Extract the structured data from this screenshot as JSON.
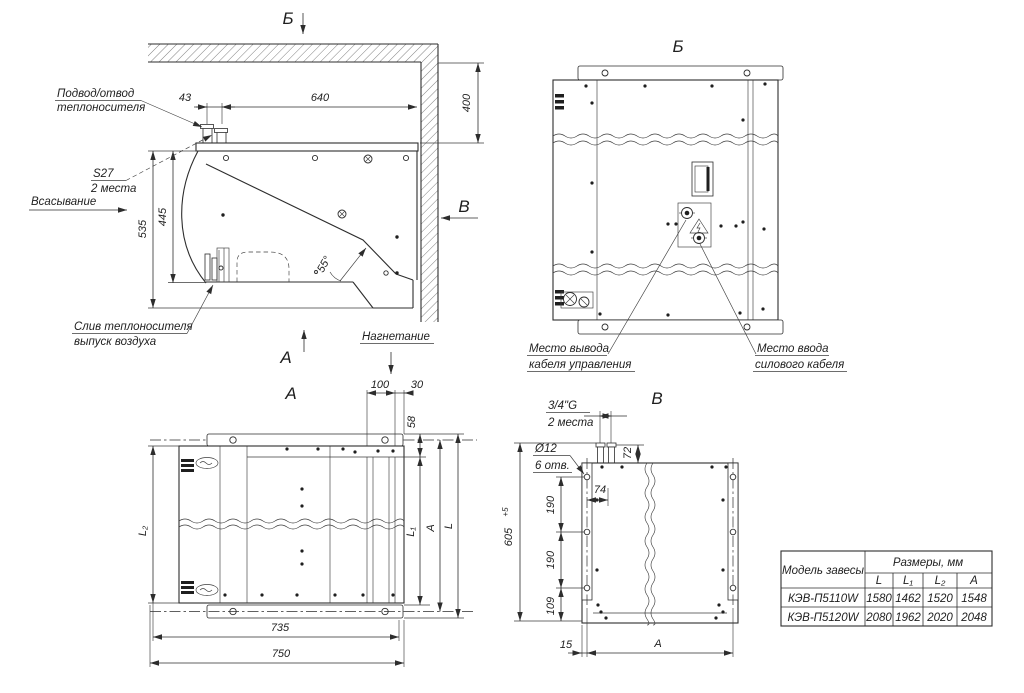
{
  "side_view": {
    "marker_b_top": "Б",
    "marker_a": "А",
    "marker_v": "В",
    "label_supply_1": "Подвод/отвод",
    "label_supply_2": "теплоносителя",
    "label_s27_1": "S27",
    "label_s27_2": "2 места",
    "label_suction": "Всасывание",
    "label_drain_1": "Слив теплоносителя",
    "label_drain_2": "выпуск воздуха",
    "label_discharge": "Нагнетание",
    "dim_43": "43",
    "dim_640": "640",
    "dim_400": "400",
    "dim_535": "535",
    "dim_445": "445",
    "dim_55": "55°"
  },
  "view_b": {
    "title": "Б",
    "label_control_1": "Место вывода",
    "label_control_2": "кабеля управления",
    "label_power_1": "Место ввода",
    "label_power_2": "силового кабеля"
  },
  "view_a": {
    "title": "А",
    "dim_100": "100",
    "dim_30": "30",
    "dim_58": "58",
    "dim_l1": "L₁",
    "dim_l2": "L₂",
    "dim_a": "А",
    "dim_l": "L",
    "dim_735": "735",
    "dim_750": "750"
  },
  "view_v": {
    "title": "В",
    "label_thread_1": "3/4\"G",
    "label_thread_2": "2 места",
    "label_holes_1": "Ø12",
    "label_holes_2": "6 отв.",
    "dim_72": "72",
    "dim_74": "74",
    "dim_190a": "190",
    "dim_190b": "190",
    "dim_109": "109",
    "dim_605": "605",
    "dim_605_tol": "+5",
    "dim_15": "15",
    "dim_a": "А"
  },
  "table": {
    "header_model": "Модель завесы",
    "header_sizes": "Размеры, мм",
    "col_l": "L",
    "col_l1": "L₁",
    "col_l2": "L₂",
    "col_a": "A",
    "rows": [
      {
        "model": "КЭВ-П5110W",
        "l": "1580",
        "l1": "1462",
        "l2": "1520",
        "a": "1548"
      },
      {
        "model": "КЭВ-П5120W",
        "l": "2080",
        "l1": "1962",
        "l2": "2020",
        "a": "2048"
      }
    ]
  }
}
